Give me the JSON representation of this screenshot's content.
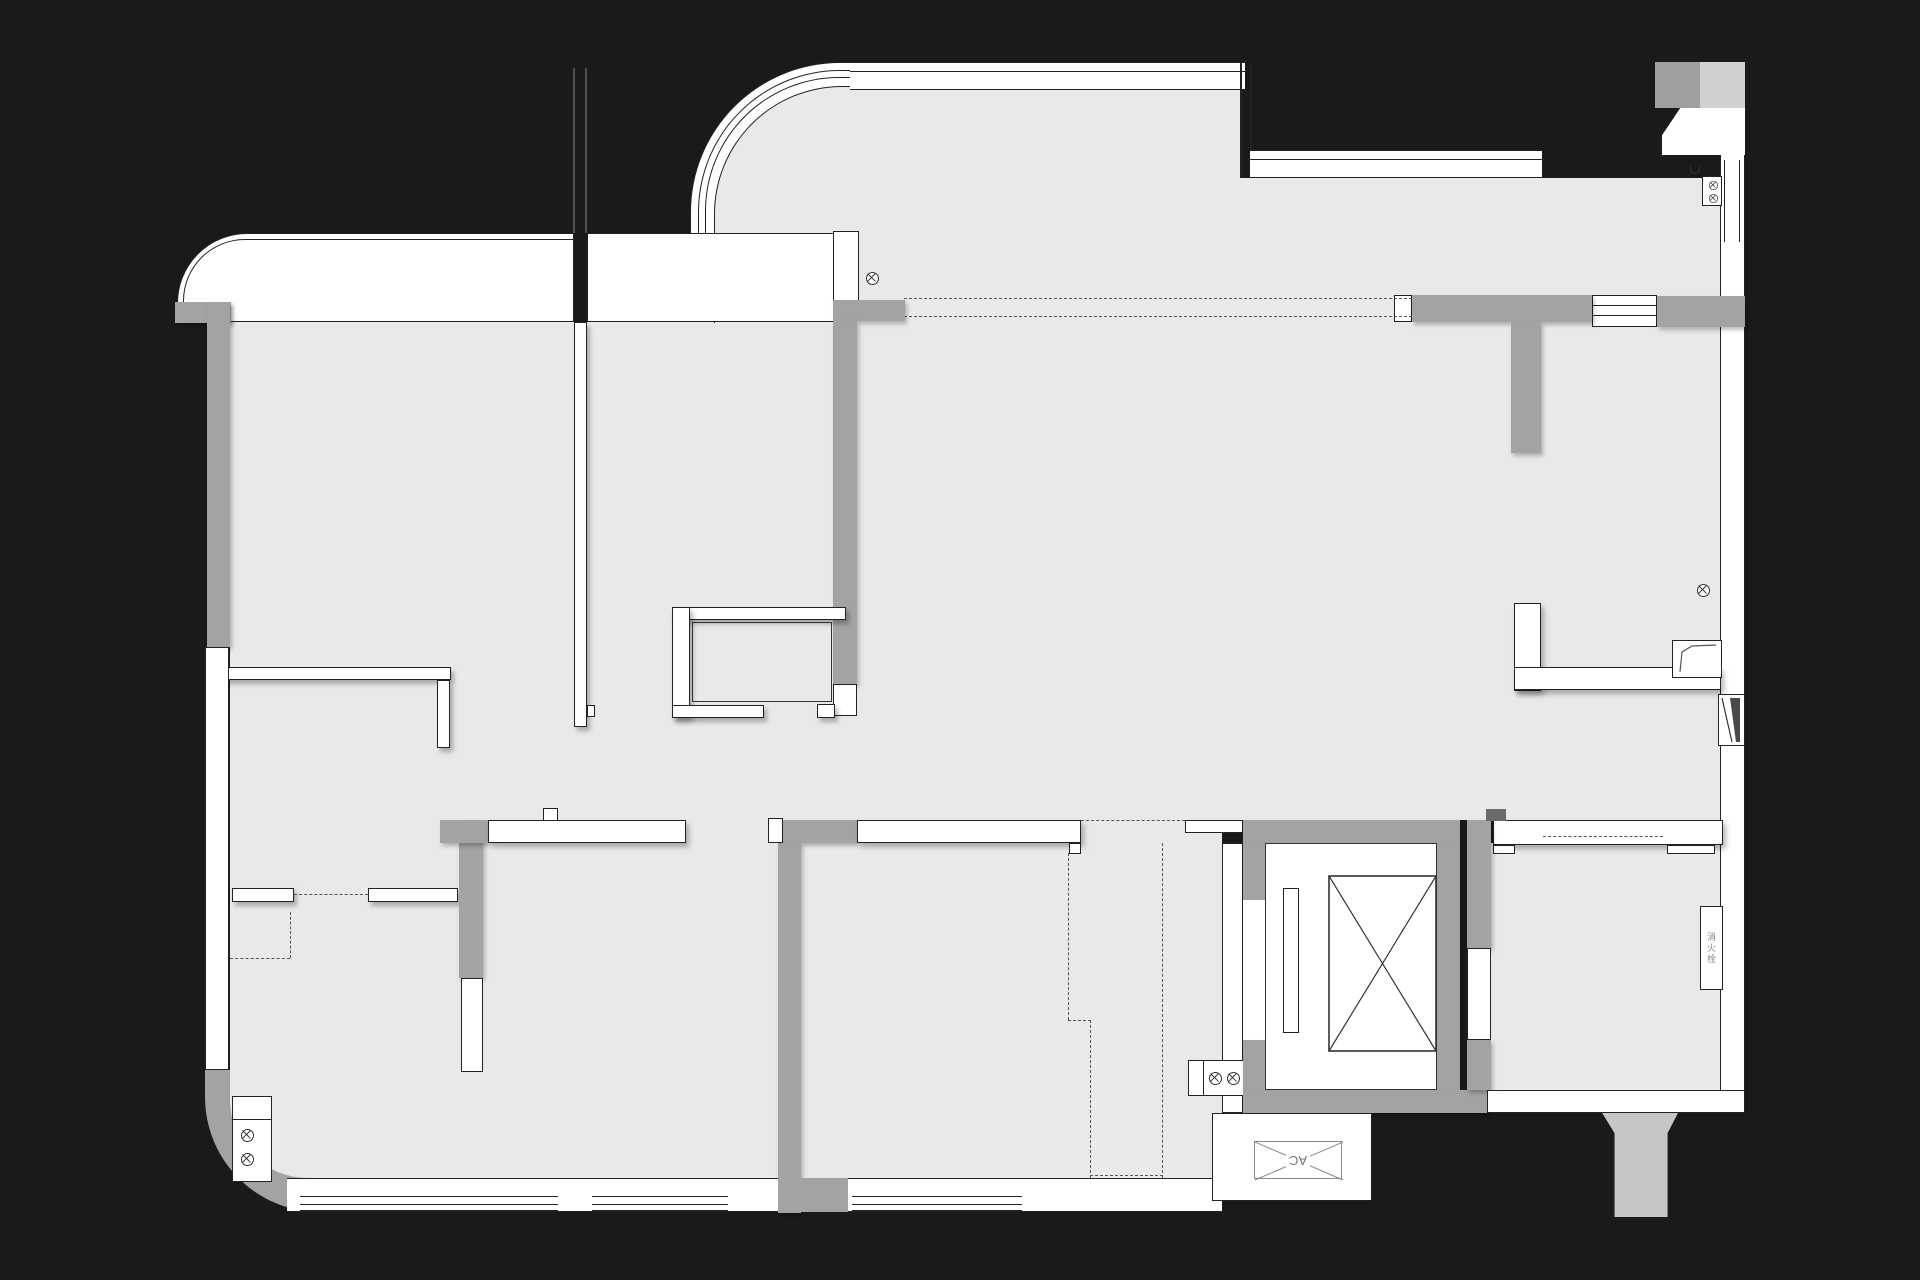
{
  "meta": {
    "kind": "architectural-floor-plan",
    "canvas_width": 1920,
    "canvas_height": 1280
  },
  "labels": {
    "ac": "AC",
    "hydrant": "消火栓"
  },
  "colors": {
    "bg": "#1a1a1a",
    "floor": "#e9e9e9",
    "wall_gray": "#a3a3a3",
    "line": "#222222",
    "dash": "#555555",
    "stair": "#c6c6c6",
    "patch_gray": "#9f9f9f",
    "patch_light": "#cfcfcf"
  }
}
